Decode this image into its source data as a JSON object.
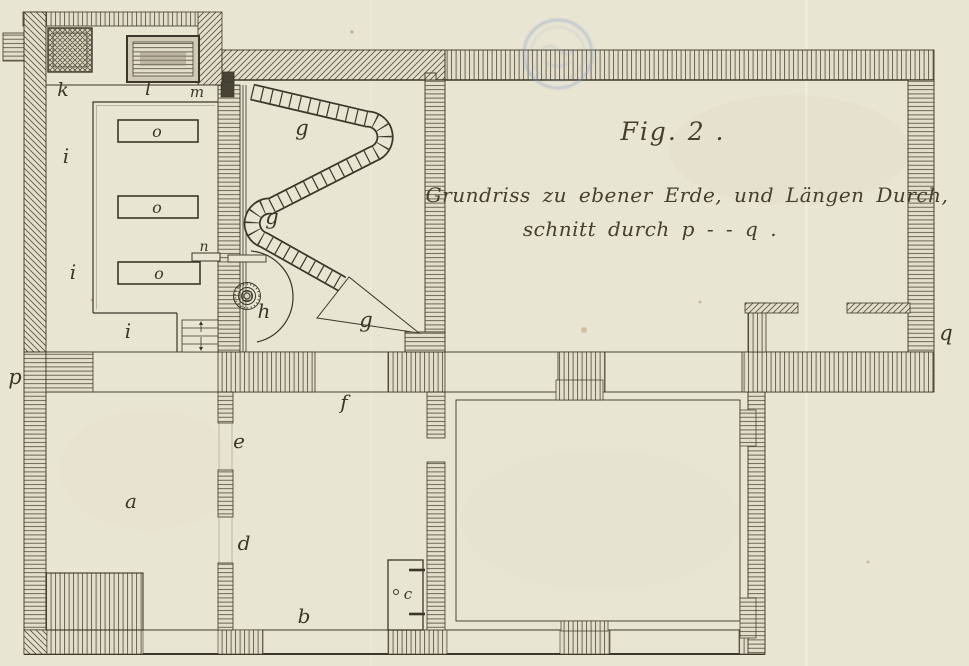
{
  "figure": {
    "fig_label": "Fig. 2 .",
    "caption_line1": "Grundriss zu ebener Erde, und Längen Durch,",
    "caption_line2": "schnitt durch p - - q ."
  },
  "plan_labels": {
    "a": "a",
    "b": "b",
    "c": "c",
    "d": "d",
    "e": "e",
    "f": "f",
    "g": "g",
    "h": "h",
    "i": "i",
    "k": "k",
    "l": "l",
    "m": "m",
    "n": "n",
    "o": "o",
    "p": "p",
    "q": "q"
  },
  "colors": {
    "paper": "#e8e5d3",
    "ink": "#3b372a",
    "hatch": "#57523f",
    "stamp_blue": "#8fa0c6"
  }
}
